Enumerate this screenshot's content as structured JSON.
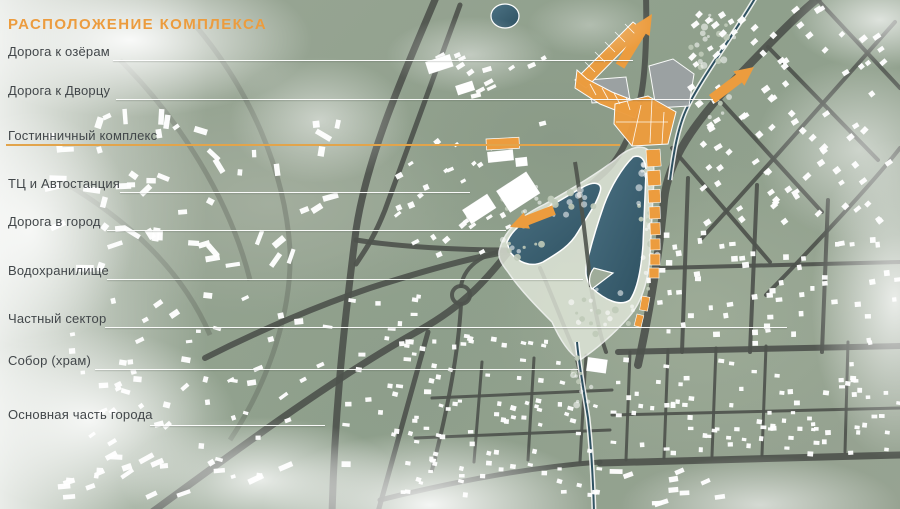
{
  "title": {
    "text": "РАСПОЛОЖЕНИЕ КОМПЛЕКСА"
  },
  "colors": {
    "accent": "#EC9C3E",
    "underline": "#E2A44B",
    "label_text": "#42474A",
    "leader_line": "#FFFFFF",
    "road": "#4E534D",
    "land": "#95A191",
    "water": "#4C7284",
    "water_deep": "#2E5161",
    "shore_band": "#E3E9DC",
    "building": "#FFFFFF",
    "gray_structure": "#9CA2A4",
    "tree": "#BFCAB8"
  },
  "legend": {
    "items": [
      {
        "label": "Дорога к озёрам",
        "text_y": 45,
        "line_y": 60,
        "line_x1": 113,
        "line_x2": 633,
        "underline": false
      },
      {
        "label": "Дорога к Дворцу",
        "text_y": 84,
        "line_y": 99,
        "line_x1": 116,
        "line_x2": 713,
        "underline": false
      },
      {
        "label": "Гостинничный комплекс",
        "text_y": 129,
        "line_y": 144,
        "line_x1": 6,
        "line_x2": 620,
        "underline": true
      },
      {
        "label": "ТЦ и Автостанция",
        "text_y": 177,
        "line_y": 192,
        "line_x1": 120,
        "line_x2": 470,
        "underline": false
      },
      {
        "label": "Дорога в город",
        "text_y": 215,
        "line_y": 230,
        "line_x1": 107,
        "line_x2": 506,
        "underline": false
      },
      {
        "label": "Водохранилище",
        "text_y": 264,
        "line_y": 279,
        "line_x1": 107,
        "line_x2": 583,
        "underline": false
      },
      {
        "label": "Частный сектор",
        "text_y": 312,
        "line_y": 327,
        "line_x1": 105,
        "line_x2": 787,
        "underline": false
      },
      {
        "label": "Собор (храм)",
        "text_y": 354,
        "line_y": 369,
        "line_x1": 95,
        "line_x2": 578,
        "underline": false
      },
      {
        "label": "Основная часть города",
        "text_y": 408,
        "line_y": 425,
        "line_x1": 150,
        "line_x2": 325,
        "underline": false
      }
    ]
  },
  "map": {
    "roads_faint": [
      "M195,25 C250,90 285,170 290,250 C292,310 270,380 230,440",
      "M60,180 C120,215 180,265 210,335",
      "M120,60 C180,120 230,200 250,280"
    ],
    "roads_major": [
      {
        "d": "M437,-5 C410,60 368,150 356,230 C346,310 335,400 332,515",
        "w": 7
      },
      {
        "d": "M460,5 L385,210 C374,238 364,252 356,264",
        "w": 5
      },
      {
        "d": "M148,515 C230,455 330,380 420,330 C470,302 492,272 510,250",
        "w": 7
      },
      {
        "d": "M510,250 C545,222 580,195 605,172 C622,156 633,130 640,100 C645,80 647,40 646,-5",
        "w": 6
      },
      {
        "d": "M638,365 C652,300 660,245 664,200 C668,162 690,125 747,67 C775,38 800,12 822,-5",
        "w": 8
      },
      {
        "d": "M505,252 C470,258 420,272 370,288 C320,305 260,330 205,358",
        "w": 6
      },
      {
        "d": "M356,240 C400,247 460,250 506,250",
        "w": 5
      },
      {
        "d": "M461,286 C465,262 490,252 508,250",
        "w": 4
      },
      {
        "d": "M461,304 C458,360 445,420 432,470",
        "w": 4
      },
      {
        "d": "M540,268 C552,295 562,322 572,345 C577,357 580,370 582,385",
        "w": 4
      },
      {
        "d": "M591,287 C596,315 600,335 606,352",
        "w": 4
      },
      {
        "d": "M702,238 C760,175 830,95 895,22",
        "w": 4
      },
      {
        "d": "M766,295 C820,240 875,180 900,148",
        "w": 4
      },
      {
        "d": "M718,98 L822,212",
        "w": 4
      },
      {
        "d": "M768,47 L878,160",
        "w": 4
      },
      {
        "d": "M818,0 L900,88",
        "w": 4
      },
      {
        "d": "M672,148 L770,262",
        "w": 4
      },
      {
        "d": "M688,178 L682,352",
        "w": 4
      },
      {
        "d": "M757,185 L750,352",
        "w": 4
      },
      {
        "d": "M828,200 L822,352",
        "w": 4
      },
      {
        "d": "M660,268 L900,262",
        "w": 4
      },
      {
        "d": "M618,352 L900,346",
        "w": 6
      },
      {
        "d": "M600,463 L900,455",
        "w": 7
      },
      {
        "d": "M600,462 C520,468 440,485 380,500",
        "w": 5
      },
      {
        "d": "M428,332 L378,512",
        "w": 5
      },
      {
        "d": "M482,362 L474,462",
        "w": 3
      },
      {
        "d": "M534,358 L528,460",
        "w": 3
      },
      {
        "d": "M586,355 L580,462",
        "w": 3
      },
      {
        "d": "M432,398 L612,390",
        "w": 3
      },
      {
        "d": "M415,438 L610,430",
        "w": 3
      },
      {
        "d": "M630,352 L626,460",
        "w": 3
      },
      {
        "d": "M668,350 L664,458",
        "w": 3
      },
      {
        "d": "M716,348 L712,456",
        "w": 3
      },
      {
        "d": "M766,346 L762,455",
        "w": 3
      },
      {
        "d": "M848,342 L845,452",
        "w": 3
      },
      {
        "d": "M612,415 L900,408",
        "w": 3
      }
    ],
    "roundabout": {
      "cx": 461,
      "cy": 295,
      "r": 9,
      "w": 4
    },
    "lake": {
      "halo": "M500,248 C505,230 520,216 545,204 C570,190 595,175 615,160 C625,150 640,143 648,150 C654,156 655,170 653,195 L650,255 C648,285 640,305 628,318 C610,338 592,352 580,360 C570,355 560,340 552,322 C540,310 520,290 508,272 C500,262 497,256 500,248 Z",
      "west": "M507,242 C512,230 525,220 540,212 C558,202 572,193 585,186 C595,181 603,183 600,192 C596,205 588,215 578,232 C570,246 558,253 543,262 C530,268 518,262 510,252 Z",
      "east": "M633,157 C641,154 646,160 646,172 L643,245 C641,272 637,290 630,300 C620,307 605,300 592,288 C586,281 584,272 588,258 C592,242 597,225 604,205 C611,186 622,168 633,157 Z",
      "island": "M592,289 L613,273 L594,268 C589,274 588,283 592,289 Z",
      "dam": "M575,162 C582,205 586,245 591,287",
      "pond": {
        "cx": 505,
        "cy": 16,
        "rx": 14,
        "ry": 12
      }
    },
    "streams": [
      "M757,-5 C737,30 700,80 686,110 C678,128 674,150 670,180",
      "M577,342 C579,365 584,392 588,418 C591,445 593,478 594,512"
    ],
    "gray_structures": [
      "M588,80 L626,77 L630,100 L592,103 Z",
      "M649,66 L673,59 L694,74 L689,106 L656,108 Z"
    ],
    "complex_polys": [
      "M575,80 L633,22 L643,30 L586,88 Z",
      "M577,70 L587,79 L612,92 L640,103 L635,118 L600,104 L575,88 Z",
      "M615,104 L648,96 L676,112 L668,144 L632,146 L614,124 Z"
    ],
    "parcel_lines": [
      "M585,62 L595,72",
      "M595,52 L605,62",
      "M605,42 L615,52",
      "M615,32 L625,42",
      "M625,24 L635,34",
      "M590,84 L596,95",
      "M602,88 L608,99",
      "M614,93 L620,104",
      "M626,97 L630,110",
      "M632,146 L641,105",
      "M650,143 L652,99",
      "M662,144 L664,112",
      "M616,122 L668,122"
    ],
    "strip_buildings": [
      {
        "x": 646,
        "y": 150,
        "w": 14,
        "h": 17,
        "r": -4
      },
      {
        "x": 647,
        "y": 171,
        "w": 13,
        "h": 15,
        "r": -4
      },
      {
        "x": 648,
        "y": 190,
        "w": 12,
        "h": 13,
        "r": -3
      },
      {
        "x": 649,
        "y": 207,
        "w": 11,
        "h": 12,
        "r": -2
      },
      {
        "x": 650,
        "y": 223,
        "w": 10,
        "h": 12,
        "r": -2
      },
      {
        "x": 650,
        "y": 239,
        "w": 10,
        "h": 11,
        "r": -1
      },
      {
        "x": 650,
        "y": 254,
        "w": 10,
        "h": 11,
        "r": 0
      },
      {
        "x": 649,
        "y": 268,
        "w": 10,
        "h": 10,
        "r": 0
      },
      {
        "x": 642,
        "y": 296,
        "w": 8,
        "h": 14,
        "r": 10
      },
      {
        "x": 637,
        "y": 314,
        "w": 7,
        "h": 12,
        "r": 14
      }
    ],
    "orange_buildings": [
      {
        "x": 486,
        "y": 139,
        "w": 33,
        "h": 11,
        "r": -3
      }
    ],
    "buildings_large": [
      {
        "x": 496,
        "y": 191,
        "w": 36,
        "h": 26,
        "r": -33
      },
      {
        "x": 462,
        "y": 210,
        "w": 30,
        "h": 17,
        "r": -33
      },
      {
        "x": 487,
        "y": 152,
        "w": 26,
        "h": 11,
        "r": -6
      },
      {
        "x": 515,
        "y": 158,
        "w": 12,
        "h": 9,
        "r": -6
      },
      {
        "x": 588,
        "y": 357,
        "w": 20,
        "h": 14,
        "r": 8
      },
      {
        "x": 425,
        "y": 62,
        "w": 26,
        "h": 13,
        "r": -18
      },
      {
        "x": 455,
        "y": 86,
        "w": 18,
        "h": 10,
        "r": -18
      }
    ],
    "arrows": [
      {
        "x1": 620,
        "y1": 66,
        "x2": 652,
        "y2": 14,
        "w": 10,
        "head": 20
      },
      {
        "x1": 712,
        "y1": 99,
        "x2": 754,
        "y2": 67,
        "w": 10,
        "head": 19
      },
      {
        "x1": 554,
        "y1": 210,
        "x2": 510,
        "y2": 227,
        "w": 10,
        "head": 18
      }
    ],
    "house_fields": [
      {
        "x": 690,
        "y": 8,
        "w": 205,
        "h": 215,
        "n": 95,
        "angle": -38,
        "avar": 8,
        "wmin": 5,
        "wmax": 8,
        "hmin": 4,
        "hmax": 6,
        "seed": 11
      },
      {
        "x": 648,
        "y": 232,
        "w": 250,
        "h": 112,
        "n": 60,
        "angle": -4,
        "avar": 6,
        "wmin": 4,
        "wmax": 7,
        "hmin": 4,
        "hmax": 6,
        "seed": 22
      },
      {
        "x": 612,
        "y": 358,
        "w": 288,
        "h": 96,
        "n": 85,
        "angle": 2,
        "avar": 6,
        "wmin": 4,
        "wmax": 6,
        "hmin": 3,
        "hmax": 5,
        "seed": 33
      },
      {
        "x": 390,
        "y": 335,
        "w": 215,
        "h": 160,
        "n": 95,
        "angle": 8,
        "avar": 10,
        "wmin": 4,
        "wmax": 6,
        "hmin": 3,
        "hmax": 5,
        "seed": 44
      },
      {
        "x": 395,
        "y": 135,
        "w": 115,
        "h": 120,
        "n": 30,
        "angle": -32,
        "avar": 10,
        "wmin": 4,
        "wmax": 8,
        "hmin": 3,
        "hmax": 6,
        "seed": 55
      },
      {
        "x": 440,
        "y": 55,
        "w": 120,
        "h": 70,
        "n": 14,
        "angle": -25,
        "avar": 12,
        "wmin": 5,
        "wmax": 10,
        "hmin": 3,
        "hmax": 5,
        "seed": 66
      },
      {
        "x": 35,
        "y": 115,
        "w": 310,
        "h": 160,
        "n": 55,
        "angle": -20,
        "avar": 80,
        "wmin": 5,
        "wmax": 18,
        "hmin": 4,
        "hmax": 7,
        "seed": 77
      },
      {
        "x": 70,
        "y": 290,
        "w": 260,
        "h": 190,
        "n": 60,
        "angle": -12,
        "avar": 30,
        "wmin": 4,
        "wmax": 10,
        "hmin": 3,
        "hmax": 6,
        "seed": 88
      },
      {
        "x": 345,
        "y": 295,
        "w": 90,
        "h": 130,
        "n": 25,
        "angle": 5,
        "avar": 10,
        "wmin": 4,
        "wmax": 8,
        "hmin": 3,
        "hmax": 5,
        "seed": 99
      },
      {
        "x": 615,
        "y": 468,
        "w": 160,
        "h": 38,
        "n": 10,
        "angle": 80,
        "avar": 15,
        "wmin": 4,
        "wmax": 6,
        "hmin": 9,
        "hmax": 16,
        "seed": 13
      },
      {
        "x": 60,
        "y": 455,
        "w": 300,
        "h": 45,
        "n": 16,
        "angle": 75,
        "avar": 20,
        "wmin": 4,
        "wmax": 6,
        "hmin": 8,
        "hmax": 16,
        "seed": 12
      }
    ],
    "avoid_zones": [
      {
        "cx": 600,
        "cy": 237,
        "r": 56
      },
      {
        "cx": 556,
        "cy": 222,
        "r": 40
      },
      {
        "cx": 592,
        "cy": 318,
        "r": 36
      },
      {
        "cx": 578,
        "cy": 352,
        "r": 22
      }
    ],
    "tree_fields": [
      {
        "cx": 555,
        "cy": 200,
        "rx": 58,
        "ry": 16,
        "n": 24,
        "seed": 5
      },
      {
        "cx": 600,
        "cy": 312,
        "rx": 34,
        "ry": 24,
        "n": 20,
        "seed": 6
      },
      {
        "cx": 648,
        "cy": 225,
        "rx": 11,
        "ry": 68,
        "n": 22,
        "seed": 7
      },
      {
        "cx": 582,
        "cy": 382,
        "rx": 14,
        "ry": 30,
        "n": 12,
        "seed": 8
      },
      {
        "cx": 715,
        "cy": 65,
        "rx": 26,
        "ry": 55,
        "n": 22,
        "seed": 9
      },
      {
        "cx": 522,
        "cy": 240,
        "rx": 20,
        "ry": 20,
        "n": 10,
        "seed": 10
      }
    ],
    "fog": [
      {
        "x": 130,
        "y": 40,
        "rx": 260,
        "ry": 110,
        "a": 0.92
      },
      {
        "x": 30,
        "y": 230,
        "rx": 150,
        "ry": 170,
        "a": 0.75
      },
      {
        "x": 90,
        "y": 420,
        "rx": 210,
        "ry": 130,
        "a": 0.85
      },
      {
        "x": 430,
        "y": 505,
        "rx": 240,
        "ry": 105,
        "a": 0.9
      },
      {
        "x": 260,
        "y": 480,
        "rx": 200,
        "ry": 90,
        "a": 0.8
      },
      {
        "x": 895,
        "y": 300,
        "rx": 120,
        "ry": 230,
        "a": 0.8
      },
      {
        "x": 880,
        "y": 20,
        "rx": 130,
        "ry": 70,
        "a": 0.7
      },
      {
        "x": 860,
        "y": 150,
        "rx": 150,
        "ry": 130,
        "a": 0.55
      },
      {
        "x": 470,
        "y": 55,
        "rx": 120,
        "ry": 55,
        "a": 0.45
      },
      {
        "x": 320,
        "y": 120,
        "rx": 130,
        "ry": 90,
        "a": 0.5
      },
      {
        "x": 760,
        "y": 505,
        "rx": 200,
        "ry": 70,
        "a": 0.6
      },
      {
        "x": 590,
        "y": 25,
        "rx": 90,
        "ry": 45,
        "a": 0.3
      }
    ]
  }
}
